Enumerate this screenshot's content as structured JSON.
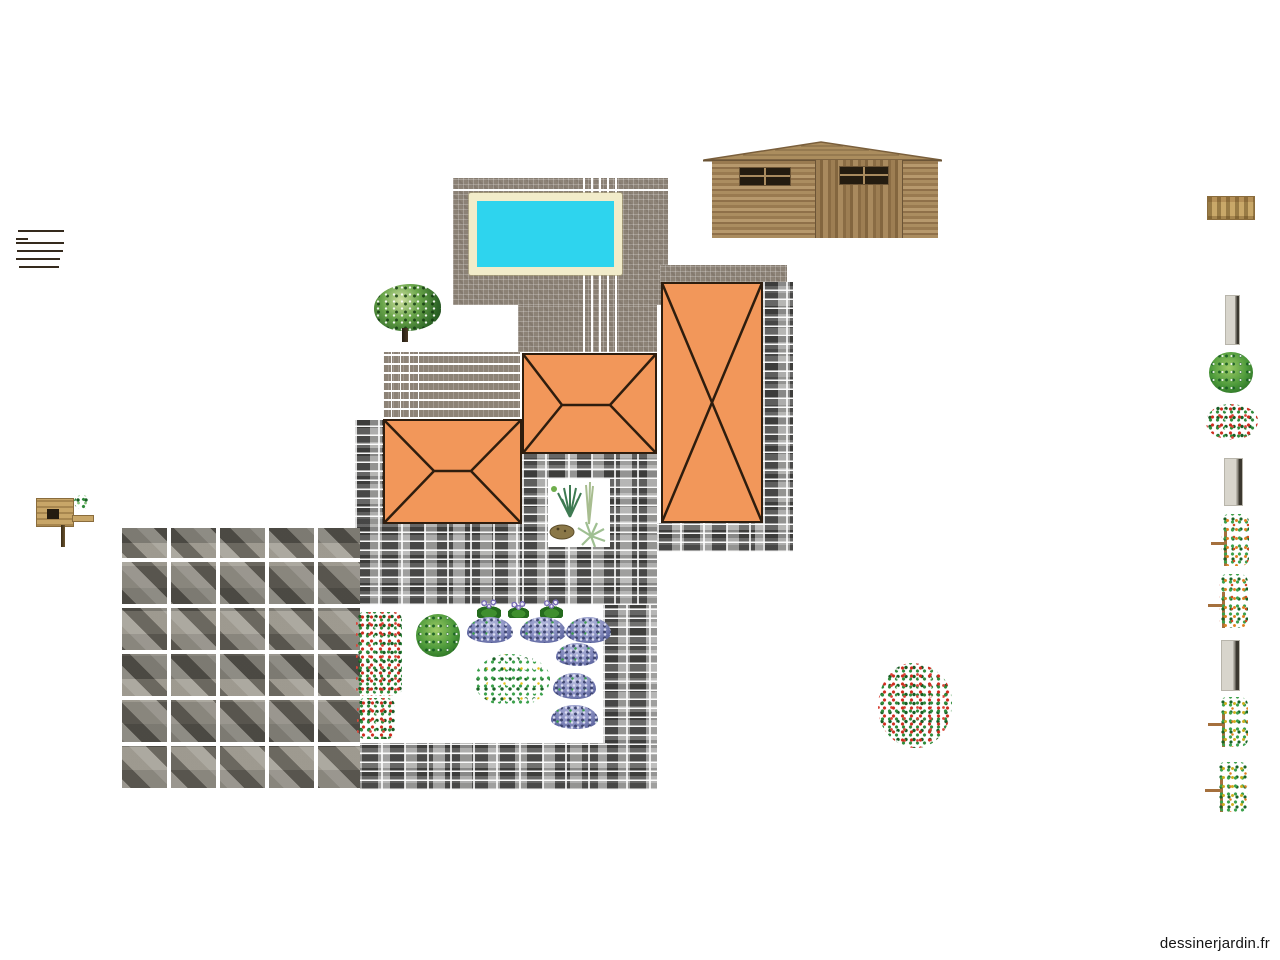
{
  "app": {
    "watermark": "dessinerjardin.fr"
  },
  "colors": {
    "background": "#ffffff",
    "roof_fill": "#f2975a",
    "roof_line": "#2e1d0e",
    "pool_water": "#2ed4ee",
    "pool_coping": "#f2ecca",
    "deck_tile": "#8c8276",
    "stone_path": "#7c7c7a",
    "shed_wood": "#a3835c",
    "lavender": "#7d84b8"
  },
  "canvas_objects": [
    {
      "name": "wood-plank-stack"
    },
    {
      "name": "paved-deck"
    },
    {
      "name": "swimming-pool"
    },
    {
      "name": "wooden-shed"
    },
    {
      "name": "hip-roof-left"
    },
    {
      "name": "hip-roof-middle"
    },
    {
      "name": "gable-roof-right"
    },
    {
      "name": "stone-pathway"
    },
    {
      "name": "flagstone-patio"
    },
    {
      "name": "tree"
    },
    {
      "name": "flower-hedge"
    },
    {
      "name": "round-shrub"
    },
    {
      "name": "white-flower-shrub"
    },
    {
      "name": "pansy",
      "count": 3
    },
    {
      "name": "lavender-bush",
      "count": 6
    },
    {
      "name": "rockery-patch"
    },
    {
      "name": "red-flower-shrub"
    },
    {
      "name": "birdhouse"
    }
  ],
  "palette": {
    "items": [
      {
        "name": "wooden-planter"
      },
      {
        "name": "stone-slab"
      },
      {
        "name": "green-shrub"
      },
      {
        "name": "red-flower-shrub"
      },
      {
        "name": "stone-slab"
      },
      {
        "name": "espalier-orange"
      },
      {
        "name": "espalier-orange"
      },
      {
        "name": "stone-slab"
      },
      {
        "name": "espalier-yellow"
      },
      {
        "name": "espalier-yellow"
      }
    ]
  }
}
